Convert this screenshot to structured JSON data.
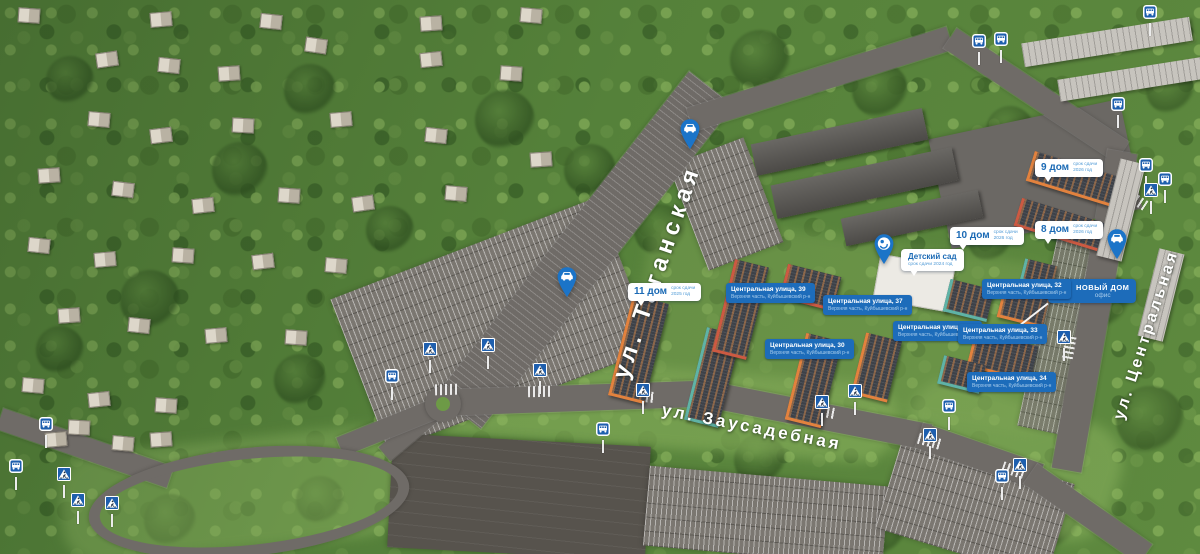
{
  "colors": {
    "label_blue": "#1d6cba",
    "sign_blue": "#1e5fae",
    "pin_blue": "#1b74c8",
    "text_blue": "#1b6ab5",
    "road_grey": "#6f6b67",
    "forest_green": "#55813a"
  },
  "streets": [
    {
      "id": "taganskaya",
      "label": "ул. Таганская"
    },
    {
      "id": "zausadebnaya",
      "label": "ул. Заусадебная"
    },
    {
      "id": "centralnaya",
      "label": "ул. Центральная"
    }
  ],
  "house_labels": [
    {
      "title": "11 дом",
      "note_line1": "срок сдачи",
      "note_line2": "2025 год",
      "x": 628,
      "y": 283
    },
    {
      "title": "10 дом",
      "note_line1": "срок сдачи",
      "note_line2": "2026 год",
      "x": 950,
      "y": 227
    },
    {
      "title": "9 дом",
      "note_line1": "срок сдачи",
      "note_line2": "2026 год",
      "x": 1035,
      "y": 159
    },
    {
      "title": "8 дом",
      "note_line1": "срок сдачи",
      "note_line2": "2026 год",
      "x": 1035,
      "y": 221
    },
    {
      "title": "Детский сад",
      "note_line1": "срок сдачи 2024 год",
      "x": 901,
      "y": 249,
      "variant": "stacked"
    }
  ],
  "address_sub": "Верхняя часть, Куйбышевский р-н",
  "address_labels": [
    {
      "line1": "Центральная улица, 39",
      "x": 726,
      "y": 283
    },
    {
      "line1": "Центральная улица, 37",
      "x": 823,
      "y": 295
    },
    {
      "line1": "Центральная улица, 30",
      "x": 765,
      "y": 339
    },
    {
      "line1": "Центральная улица, 36",
      "x": 893,
      "y": 321
    },
    {
      "line1": "Центральная улица, 32",
      "x": 982,
      "y": 279
    },
    {
      "line1": "Центральная улица, 33",
      "x": 958,
      "y": 324
    },
    {
      "line1": "Центральная улица, 34",
      "x": 967,
      "y": 372
    }
  ],
  "office_label": {
    "title": "НОВЫЙ ДОМ",
    "subtitle": "офис",
    "x": 1048,
    "y": 279
  },
  "pins": [
    {
      "type": "car",
      "x": 678,
      "y": 118
    },
    {
      "type": "car",
      "x": 555,
      "y": 266
    },
    {
      "type": "car",
      "x": 1105,
      "y": 228
    },
    {
      "type": "kindergarten",
      "x": 872,
      "y": 233
    }
  ],
  "signs": {
    "bus": [
      [
        971,
        34
      ],
      [
        993,
        32
      ],
      [
        1110,
        97
      ],
      [
        1138,
        158
      ],
      [
        1157,
        172
      ],
      [
        384,
        369
      ],
      [
        595,
        422
      ],
      [
        941,
        399
      ],
      [
        994,
        469
      ],
      [
        38,
        417
      ],
      [
        8,
        459
      ],
      [
        1142,
        5
      ]
    ],
    "crosswalk": [
      [
        422,
        342
      ],
      [
        480,
        338
      ],
      [
        532,
        363
      ],
      [
        635,
        383
      ],
      [
        814,
        395
      ],
      [
        847,
        384
      ],
      [
        922,
        428
      ],
      [
        1012,
        458
      ],
      [
        1056,
        330
      ],
      [
        1143,
        183
      ],
      [
        56,
        467
      ],
      [
        70,
        493
      ],
      [
        104,
        496
      ]
    ]
  },
  "zebras": [
    [
      447,
      389,
      -2
    ],
    [
      540,
      391,
      -1
    ],
    [
      643,
      396,
      5
    ],
    [
      824,
      411,
      11
    ],
    [
      930,
      441,
      16
    ],
    [
      1014,
      470,
      19
    ],
    [
      1069,
      348,
      100
    ],
    [
      1137,
      200,
      33
    ]
  ],
  "new_buildings": [
    {
      "x": 620,
      "y": 298,
      "w": 34,
      "h": 100,
      "rot": 14,
      "accent": "#e2823e"
    },
    {
      "x": 695,
      "y": 330,
      "w": 32,
      "h": 92,
      "rot": 14,
      "accent": "#5fb3a6"
    },
    {
      "x": 723,
      "y": 262,
      "w": 32,
      "h": 92,
      "rot": 14,
      "accent": "#cc5a42"
    },
    {
      "x": 783,
      "y": 270,
      "w": 52,
      "h": 32,
      "rot": 14,
      "accent": "#cc5a42"
    },
    {
      "x": 795,
      "y": 336,
      "w": 34,
      "h": 86,
      "rot": 14,
      "accent": "#e2823e"
    },
    {
      "x": 858,
      "y": 336,
      "w": 34,
      "h": 60,
      "rot": 14,
      "accent": "#e2823e"
    },
    {
      "x": 946,
      "y": 284,
      "w": 42,
      "h": 30,
      "rot": 14,
      "accent": "#5fb3a6"
    },
    {
      "x": 1000,
      "y": 290,
      "w": 44,
      "h": 30,
      "rot": 14,
      "accent": "#e2823e"
    },
    {
      "x": 970,
      "y": 338,
      "w": 62,
      "h": 34,
      "rot": 14,
      "accent": "#e2823e"
    },
    {
      "x": 1022,
      "y": 262,
      "w": 30,
      "h": 20,
      "rot": 14,
      "accent": "#5fb3a6"
    },
    {
      "x": 1028,
      "y": 166,
      "w": 104,
      "h": 28,
      "rot": 17,
      "accent": "#e2823e"
    },
    {
      "x": 1016,
      "y": 210,
      "w": 84,
      "h": 26,
      "rot": 17,
      "accent": "#cc5a42"
    },
    {
      "x": 940,
      "y": 360,
      "w": 40,
      "h": 26,
      "rot": 14,
      "accent": "#5fb3a6"
    }
  ],
  "kindergarten_building": {
    "x": 876,
    "y": 260,
    "w": 74,
    "h": 44,
    "rot": 10
  },
  "industrial_buildings": [
    {
      "x": 752,
      "y": 126,
      "w": 175,
      "h": 32,
      "rot": -12
    },
    {
      "x": 772,
      "y": 166,
      "w": 185,
      "h": 34,
      "rot": -12
    },
    {
      "x": 842,
      "y": 204,
      "w": 140,
      "h": 28,
      "rot": -12
    }
  ],
  "light_buildings": [
    {
      "x": 1022,
      "y": 30,
      "w": 170,
      "h": 24,
      "rot": -9
    },
    {
      "x": 1058,
      "y": 68,
      "w": 150,
      "h": 22,
      "rot": -9
    },
    {
      "x": 1108,
      "y": 160,
      "w": 26,
      "h": 100,
      "rot": 14
    },
    {
      "x": 1148,
      "y": 250,
      "w": 26,
      "h": 90,
      "rot": 14
    }
  ],
  "village_houses": [
    [
      18,
      8,
      4
    ],
    [
      150,
      12,
      -5
    ],
    [
      260,
      14,
      6
    ],
    [
      420,
      16,
      -4
    ],
    [
      520,
      8,
      5
    ],
    [
      96,
      52,
      -8
    ],
    [
      158,
      58,
      6
    ],
    [
      218,
      66,
      -4
    ],
    [
      305,
      38,
      8
    ],
    [
      420,
      52,
      -6
    ],
    [
      500,
      66,
      4
    ],
    [
      88,
      112,
      5
    ],
    [
      150,
      128,
      -7
    ],
    [
      232,
      118,
      3
    ],
    [
      330,
      112,
      -5
    ],
    [
      425,
      128,
      6
    ],
    [
      38,
      168,
      -4
    ],
    [
      112,
      182,
      7
    ],
    [
      192,
      198,
      -6
    ],
    [
      278,
      188,
      4
    ],
    [
      352,
      196,
      -8
    ],
    [
      445,
      186,
      5
    ],
    [
      530,
      152,
      -4
    ],
    [
      28,
      238,
      6
    ],
    [
      94,
      252,
      -5
    ],
    [
      172,
      248,
      4
    ],
    [
      252,
      254,
      -7
    ],
    [
      325,
      258,
      5
    ],
    [
      58,
      308,
      -4
    ],
    [
      128,
      318,
      6
    ],
    [
      205,
      328,
      -5
    ],
    [
      285,
      330,
      4
    ],
    [
      22,
      378,
      5
    ],
    [
      88,
      392,
      -6
    ],
    [
      155,
      398,
      4
    ],
    [
      45,
      432,
      -5
    ],
    [
      68,
      420,
      3
    ],
    [
      112,
      436,
      5
    ],
    [
      150,
      432,
      -4
    ]
  ],
  "tree_clumps": [
    [
      310,
      90,
      26
    ],
    [
      505,
      120,
      30
    ],
    [
      70,
      80,
      24
    ],
    [
      240,
      170,
      28
    ],
    [
      390,
      230,
      24
    ],
    [
      150,
      300,
      30
    ],
    [
      300,
      380,
      26
    ],
    [
      60,
      350,
      24
    ],
    [
      520,
      300,
      28
    ],
    [
      590,
      170,
      26
    ],
    [
      760,
      60,
      30
    ],
    [
      880,
      90,
      28
    ],
    [
      1010,
      130,
      24
    ],
    [
      660,
      230,
      26
    ],
    [
      930,
      170,
      24
    ],
    [
      1100,
      300,
      30
    ],
    [
      1150,
      420,
      34
    ],
    [
      1050,
      520,
      30
    ],
    [
      760,
      460,
      26
    ],
    [
      560,
      470,
      24
    ],
    [
      880,
      530,
      26
    ],
    [
      170,
      520,
      26
    ],
    [
      320,
      500,
      24
    ],
    [
      990,
      240,
      22
    ],
    [
      1170,
      90,
      24
    ]
  ]
}
